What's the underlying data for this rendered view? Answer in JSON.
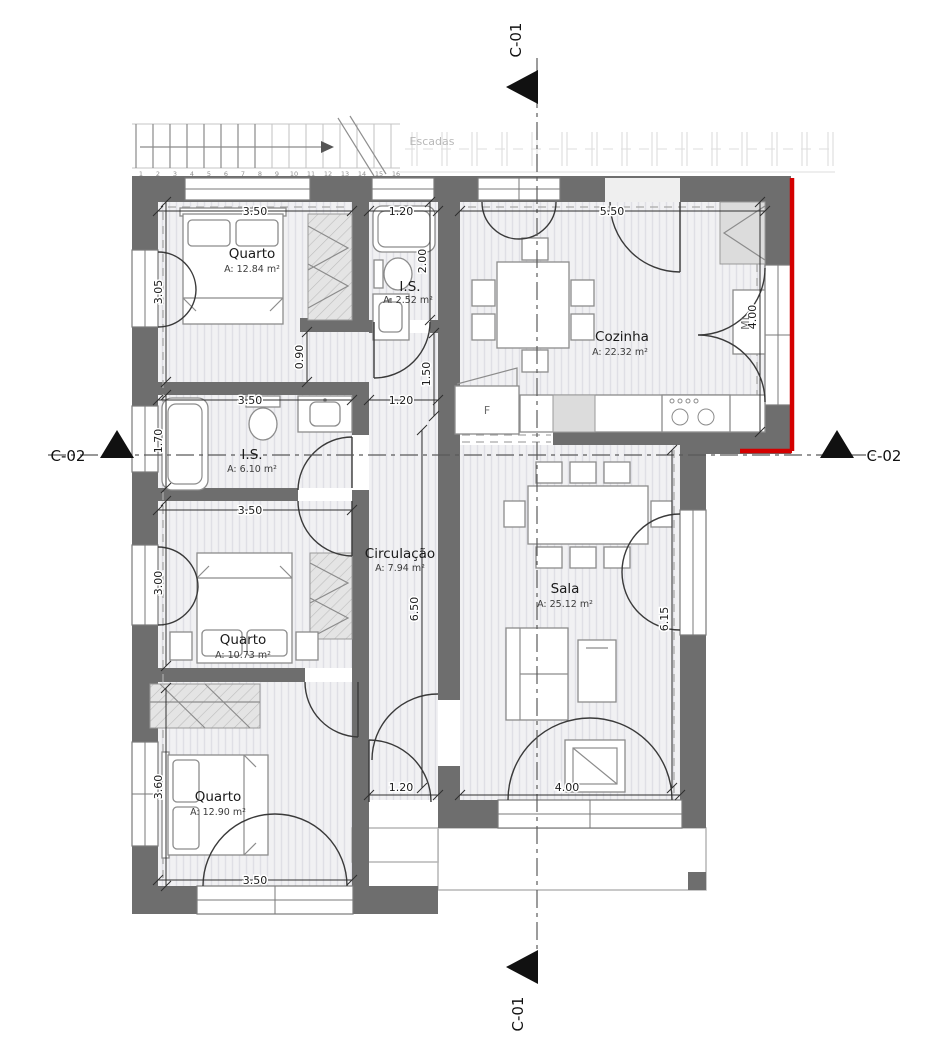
{
  "drawing": {
    "type": "residential floor plan"
  },
  "rooms": {
    "quarto1": {
      "name": "Quarto",
      "area": "A: 12.84 m²"
    },
    "is_small": {
      "name": "I.S.",
      "area": "A: 2.52 m²"
    },
    "cozinha": {
      "name": "Cozinha",
      "area": "A: 22.32 m²"
    },
    "is_mid": {
      "name": "I.S.",
      "area": "A: 6.10 m²"
    },
    "quarto2": {
      "name": "Quarto",
      "area": "A: 10.73 m²"
    },
    "circulacao": {
      "name": "Circulação",
      "area": "A: 7.94 m²"
    },
    "sala": {
      "name": "Sala",
      "area": "A: 25.12 m²"
    },
    "quarto3": {
      "name": "Quarto",
      "area": "A: 12.90 m²"
    }
  },
  "dimensions": {
    "q1_width": "3.50",
    "is_small_width": "1.20",
    "kitchen_width": "5.50",
    "q1_height": "3.05",
    "is_small_height": "2.00",
    "kitchen_height": "4.00",
    "passage_width": "0.90",
    "hall_top_height": "1.50",
    "is_mid_width": "3.50",
    "hall_door_width": "1.20",
    "is_mid_height": "1.70",
    "q2_width": "3.50",
    "q2_height": "3.00",
    "circulation_height": "6.50",
    "sala_height": "6.15",
    "q3_height": "3.60",
    "q3_width": "3.50",
    "hall_door_bottom_width": "1.20",
    "sala_door_width": "4.00"
  },
  "markers": {
    "section_c01": "C-01",
    "section_c02": "C-02"
  },
  "stairs": {
    "label": "Escadas",
    "steps": [
      "1",
      "2",
      "3",
      "4",
      "5",
      "6",
      "7",
      "8",
      "9",
      "10",
      "11",
      "12",
      "13",
      "14",
      "15",
      "16"
    ]
  },
  "appliances": {
    "fridge_label": "F",
    "washing_machine_label": "ML"
  },
  "colors": {
    "wall": "#6e6e6e",
    "red_accent": "#d40000",
    "floor": "#f1f1f3"
  }
}
